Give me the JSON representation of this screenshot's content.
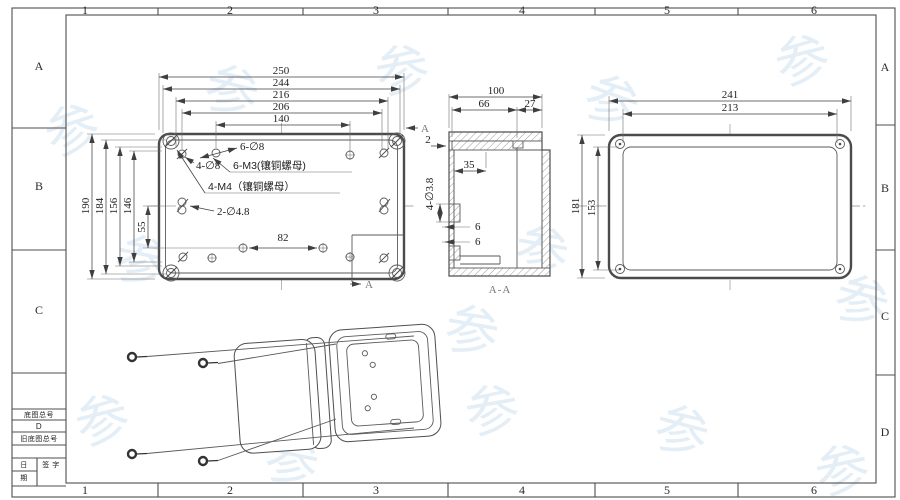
{
  "grid": {
    "cols": [
      "1",
      "2",
      "3",
      "4",
      "5",
      "6"
    ],
    "rows": [
      "A",
      "B",
      "C",
      "D"
    ]
  },
  "title_block": {
    "field_base_no": "底图总号",
    "field_d": "D",
    "field_old_base_no": "旧底图总号",
    "date_top": "日",
    "date_bottom": "期",
    "signature": "签 字"
  },
  "front_view": {
    "dims_top": [
      "250",
      "244",
      "216",
      "206",
      "140"
    ],
    "dims_left": [
      "190",
      "184",
      "156",
      "146",
      "55"
    ],
    "dim_inner": "82",
    "note_6_d8": "6-∅8",
    "note_4_d8": "4-∅8",
    "note_6_m3": "6-M3(镶铜螺母)",
    "note_4_m4": "4-M4（镶铜螺母）",
    "note_2_d48": "2-∅4.8",
    "marker_a": "A"
  },
  "section_view": {
    "dim_100": "100",
    "dim_66": "66",
    "dim_27": "27",
    "dim_2": "2",
    "dim_35": "35",
    "note_bosses": "4-∅3.8",
    "dim_6a": "6",
    "dim_6b": "6",
    "label": "A-A"
  },
  "back_view": {
    "dim_241": "241",
    "dim_213": "213",
    "dim_181": "181",
    "dim_153": "153"
  },
  "watermark": {
    "glyph": "参"
  },
  "colors": {
    "line": "#4b4b4b",
    "dim": "#3f3f3f",
    "watermark": "#cadeef"
  }
}
